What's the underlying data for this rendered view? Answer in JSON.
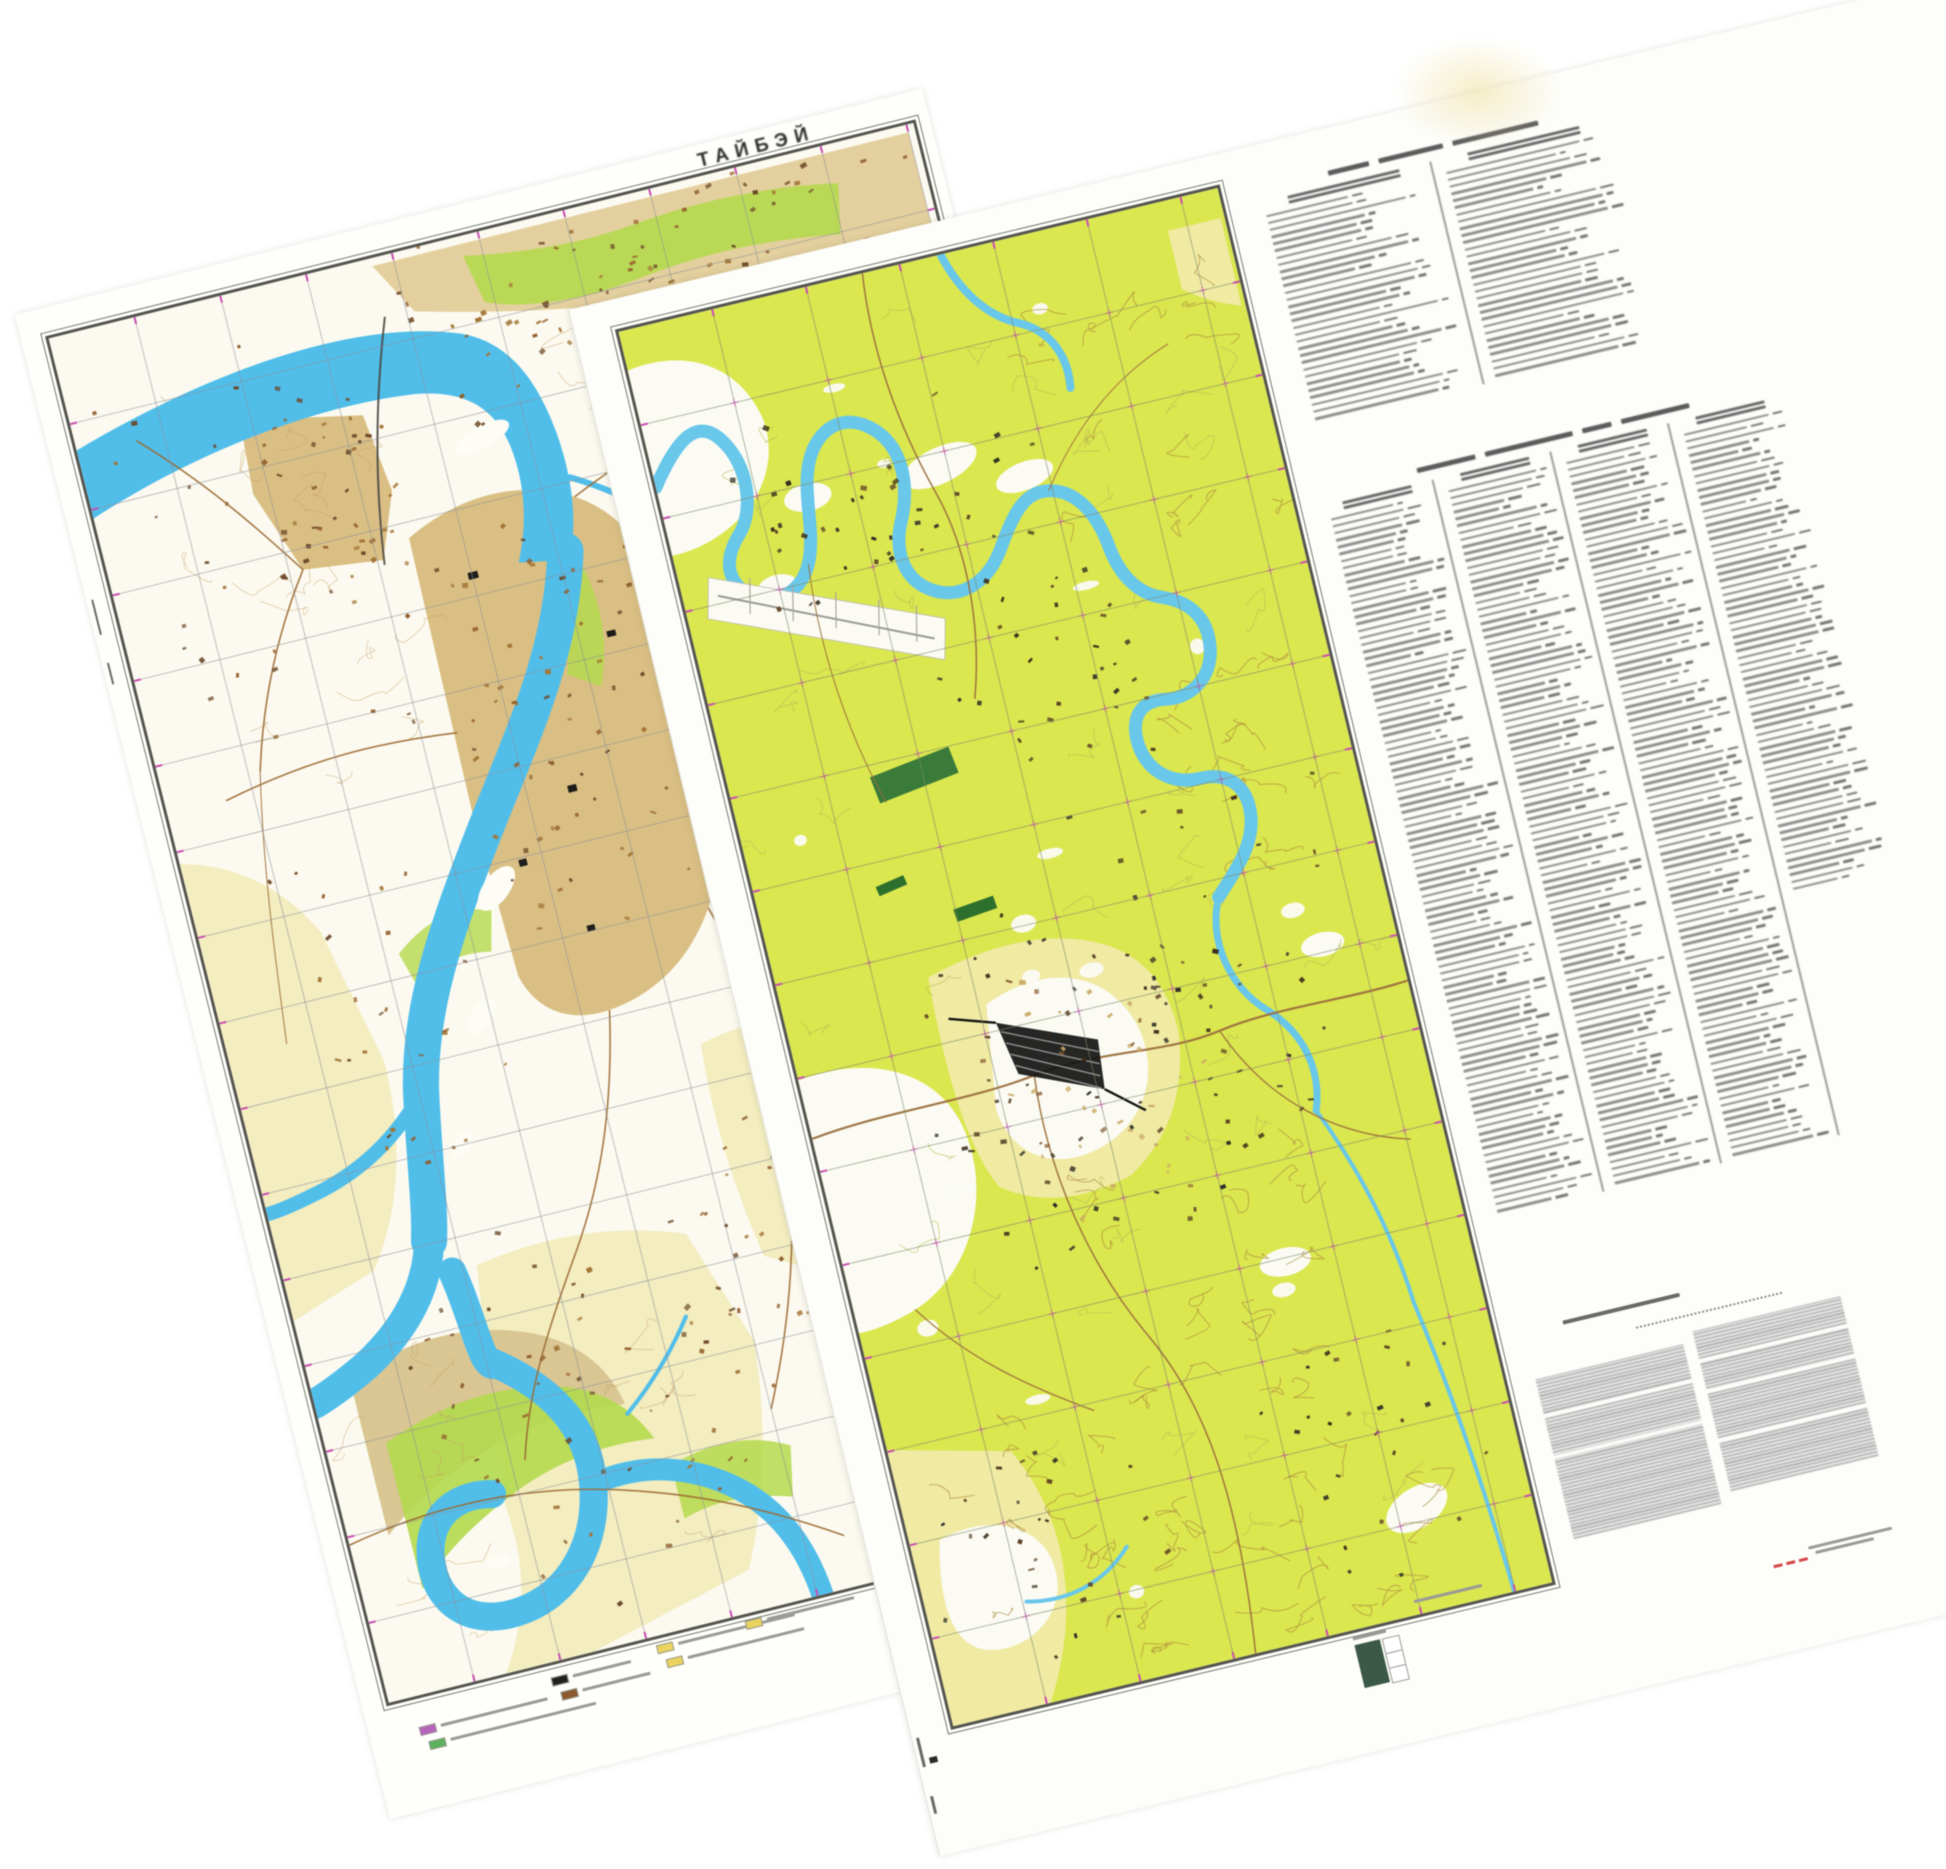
{
  "scene": {
    "background": "#ffffff"
  },
  "sheet_left": {
    "title": "ТАЙБЭЙ",
    "rotation_deg": -14,
    "colors": {
      "paper": "#fefefb",
      "frame": "#55554f",
      "river": "#54bde8",
      "city_tan": "#d9bf86",
      "city_tan_light": "#e3d0a0",
      "building_brown": "#6b482a",
      "building_brown2": "#8f5e2f",
      "landmark_black": "#1d1d1b",
      "green": "#b5d852",
      "pale_field": "#f3edc2",
      "hill_tan": "#d8c695",
      "road": "#9a6a35",
      "grid": "#8a8f99",
      "tick_magenta": "#c44fae",
      "white_patch": "#fdfcf5",
      "contour": "#c09a62"
    },
    "legend_chips": [
      {
        "color": "#b465b8"
      },
      {
        "color": "#5faf5f"
      },
      {
        "color": "#20201e"
      },
      {
        "color": "#8a5a30"
      },
      {
        "color": "#e9d463"
      },
      {
        "color": "#e9d463"
      },
      {
        "color": "#e9d463"
      }
    ]
  },
  "sheet_right": {
    "rotation_deg": -13.5,
    "colors": {
      "paper": "#fdfdfa",
      "frame": "#55554f",
      "veg": "#dbe654",
      "pale_field": "#f0eaa6",
      "white_patch": "#fbfbf4",
      "river": "#6cc6e8",
      "contour_brown": "#a9873f",
      "contour_olive": "#b7bd57",
      "road": "#9a7040",
      "rail_black": "#141412",
      "grid": "#7f8b6a",
      "tick_magenta": "#c44fae",
      "dark_green": "#3c7a3c",
      "stamp_green": "#3d5948",
      "text_gray": "#8a8a8a",
      "legend_red": "#cf4848",
      "building_tan": "#c9a96a"
    },
    "index_table_top": {
      "columns": 2,
      "rows_per_column": 30
    },
    "index_table_main": {
      "columns": 4,
      "rows_per_column": [
        100,
        100,
        100,
        66
      ]
    },
    "notes_paragraphs": 2
  }
}
